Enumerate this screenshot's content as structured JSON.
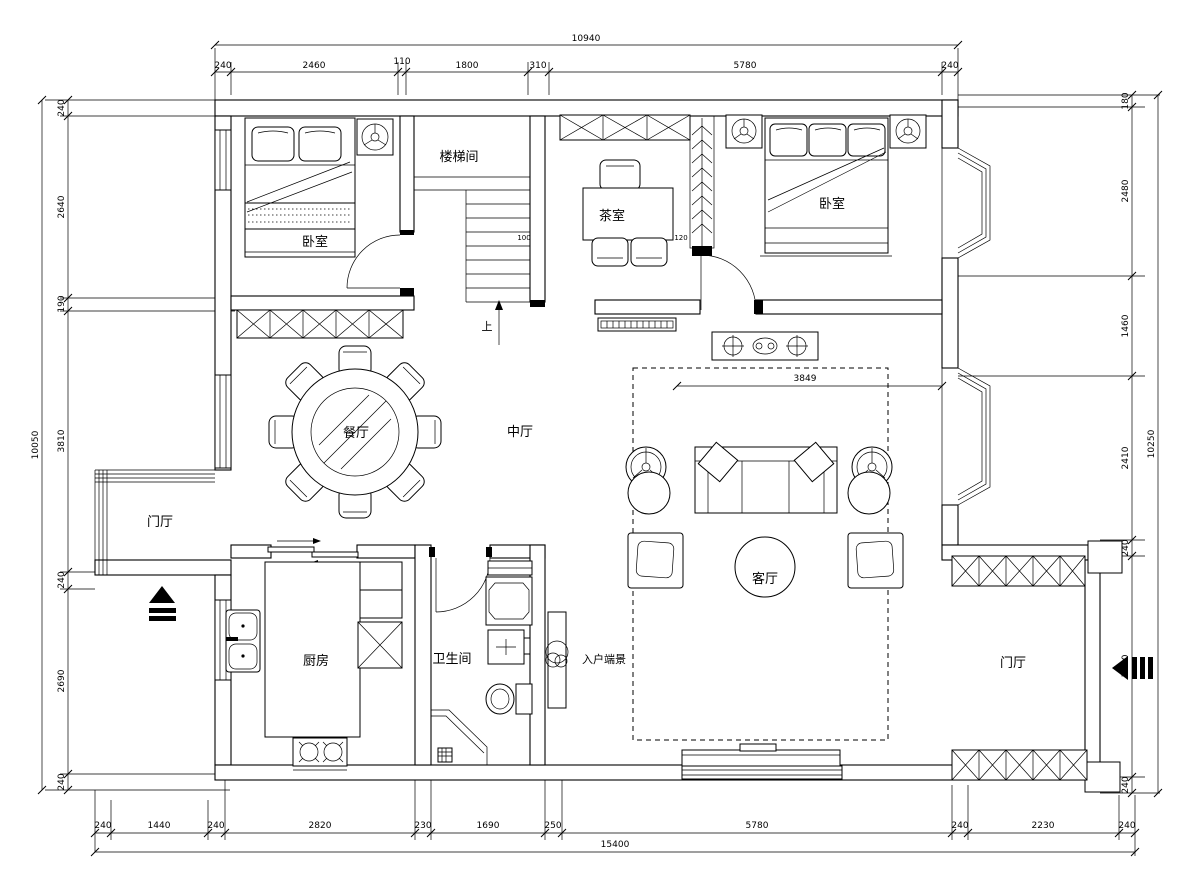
{
  "meta": {
    "drawing_type": "residential floor plan"
  },
  "colors": {
    "line": "#000000",
    "background": "#ffffff"
  },
  "rooms": {
    "bedroom_left": "卧室",
    "bedroom_right": "卧室",
    "stairwell": "楼梯间",
    "tea_room": "茶室",
    "mid_hall": "中厅",
    "dining": "餐厅",
    "foyer_left": "门厅",
    "foyer_right": "门厅",
    "kitchen": "厨房",
    "bathroom": "卫生间",
    "entry_view": "入户端景",
    "living": "客厅",
    "stairs_up": "上"
  },
  "dims": {
    "top": {
      "total": "10940",
      "segs": [
        "240",
        "2460",
        "110",
        "1800",
        "310",
        "5780",
        "240"
      ]
    },
    "bottom": {
      "total": "15400",
      "segs": [
        "240",
        "1440",
        "240",
        "2820",
        "230",
        "1690",
        "250",
        "5780",
        "240",
        "2230",
        "240"
      ]
    },
    "left": {
      "total": "10050",
      "segs": [
        "240",
        "2640",
        "190",
        "3810",
        "240",
        "2690",
        "240"
      ]
    },
    "right": {
      "total": "10250",
      "segs": [
        "180",
        "2480",
        "1460",
        "2410",
        "240",
        "3240",
        "240"
      ]
    },
    "inner": {
      "stair": "100",
      "screen": "120",
      "living_width": "3849"
    }
  }
}
